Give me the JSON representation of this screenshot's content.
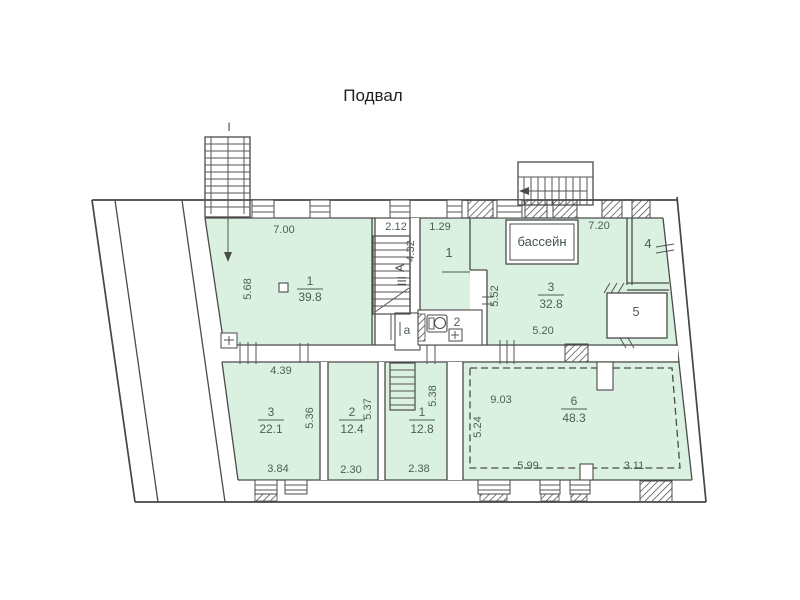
{
  "plan": {
    "title": "Подвал",
    "colors": {
      "room_fill": "#daf0e0",
      "wall_line": "#4b4b49",
      "dim_text": "#4c5f53",
      "title_text": "#1f1f1f"
    },
    "markers": {
      "stair_axis": "I",
      "section_letter": "А",
      "section_roman": "III"
    },
    "pool_label": "бассейн",
    "rooms": {
      "hall": {
        "number": "1",
        "area": "39.8",
        "dim_top": "7.00",
        "dim_left": "5.68"
      },
      "stairwell": {
        "dim_top": "2.12",
        "dim_side": "4.32"
      },
      "cell1": {
        "number": "1",
        "dim_top": "1.29"
      },
      "poolroom": {
        "number": "3",
        "area": "32.8",
        "dim_top": "7.20",
        "dim_left": "5.52",
        "dim_bottom": "5.20"
      },
      "room4": {
        "number": "4"
      },
      "room5": {
        "number": "5"
      },
      "rooma": {
        "number": "а"
      },
      "wc": {
        "number": "2"
      },
      "room3": {
        "number": "3",
        "area": "22.1",
        "dim_top": "4.39",
        "dim_right": "5.36",
        "dim_bottom": "3.84"
      },
      "room2": {
        "number": "2",
        "area": "12.4",
        "dim_right": "5.37",
        "dim_bottom": "2.30"
      },
      "room1b": {
        "number": "1",
        "area": "12.8",
        "dim_right": "5.38",
        "dim_bottom": "2.38"
      },
      "room6": {
        "number": "6",
        "area": "48.3",
        "dim_top": "9.03",
        "dim_left": "5.24",
        "dim_bottom_left": "5.99",
        "dim_bottom_right": "3.11"
      }
    }
  }
}
